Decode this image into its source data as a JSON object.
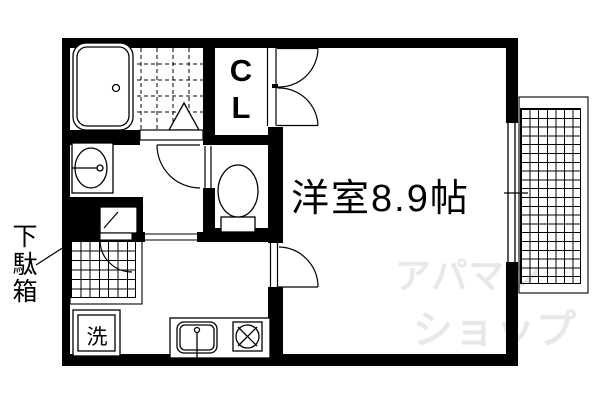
{
  "colors": {
    "wall": "#000000",
    "background": "#ffffff",
    "lines": "#000000",
    "watermark": "#e8e8e8"
  },
  "floorplan": {
    "main_room": {
      "label": "洋室8.9帖"
    },
    "closet": {
      "letter_top": "C",
      "letter_bottom": "L"
    },
    "entrance": {
      "shoe_cabinet_label": "下駄箱"
    },
    "laundry": {
      "washer_label": "洗"
    }
  },
  "watermark": {
    "line1": "アパマン",
    "line2": "ショップ"
  }
}
